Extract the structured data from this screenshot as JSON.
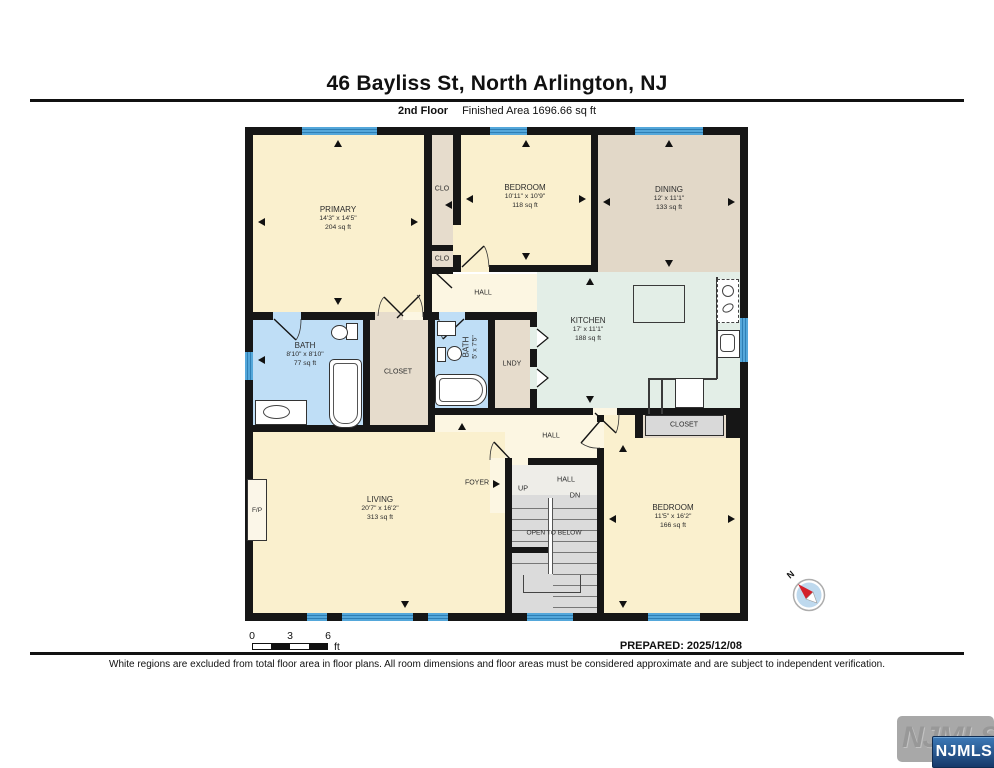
{
  "header": {
    "title": "46 Bayliss St, North Arlington, NJ",
    "floor_label": "2nd Floor",
    "finished_area_label": "Finished Area 1696.66 sq ft"
  },
  "rooms": {
    "primary": {
      "name": "PRIMARY",
      "dims": "14'3\" x 14'5\"",
      "area": "204 sq ft"
    },
    "clo_upper": {
      "name": "CLO"
    },
    "clo_lower": {
      "name": "CLO"
    },
    "bedroom_top": {
      "name": "BEDROOM",
      "dims": "10'11\" x 10'9\"",
      "area": "118 sq ft"
    },
    "dining": {
      "name": "DINING",
      "dims": "12' x 11'1\"",
      "area": "133 sq ft"
    },
    "hall_upper": {
      "name": "HALL"
    },
    "kitchen": {
      "name": "KITCHEN",
      "dims": "17' x 11'1\"",
      "area": "188 sq ft"
    },
    "bath_main": {
      "name": "BATH",
      "dims": "8'10\" x 8'10\"",
      "area": "77 sq ft"
    },
    "closet_hall": {
      "name": "CLOSET"
    },
    "bath_small": {
      "name": "BATH",
      "dims": "5' x 7'5\""
    },
    "laundry": {
      "name": "LNDY"
    },
    "hall_mid": {
      "name": "HALL"
    },
    "closet_bedroom": {
      "name": "CLOSET"
    },
    "foyer": {
      "name": "FOYER"
    },
    "living": {
      "name": "LIVING",
      "dims": "20'7\" x 16'2\"",
      "area": "313 sq ft"
    },
    "bedroom_lower": {
      "name": "BEDROOM",
      "dims": "11'5\" x 16'2\"",
      "area": "166 sq ft"
    },
    "fireplace": {
      "name": "F/P"
    },
    "stairs": {
      "hall": "HALL",
      "up": "UP",
      "dn": "DN",
      "open_to_below": "OPEN TO BELOW"
    }
  },
  "scale_bar": {
    "tick_0": "0",
    "tick_3": "3",
    "tick_6": "6",
    "unit": "ft"
  },
  "prepared_label": "PREPARED: 2025/12/08",
  "disclaimer": "White regions are excluded from total floor area in floor plans. All room dimensions and floor areas must be considered approximate and are subject to independent verification.",
  "compass": {
    "north_label": "N"
  },
  "branding": {
    "watermark_text": "NJMLS",
    "badge_text": "NJMLS"
  },
  "palette": {
    "wall": "#161616",
    "room_cream": "#FAF0CE",
    "hall_cream": "#FCF6E2",
    "dining_tan": "#E2D8C8",
    "closet_tan": "#E6DCCC",
    "kitchen_mint": "#E3EEE7",
    "bath_blue": "#BFDEF6",
    "stair_gray": "#DBDBDB",
    "window_blue": "#54A7DA",
    "window_stripe": "#2E7FB5",
    "closet_box_gray": "#D9D9D9"
  }
}
